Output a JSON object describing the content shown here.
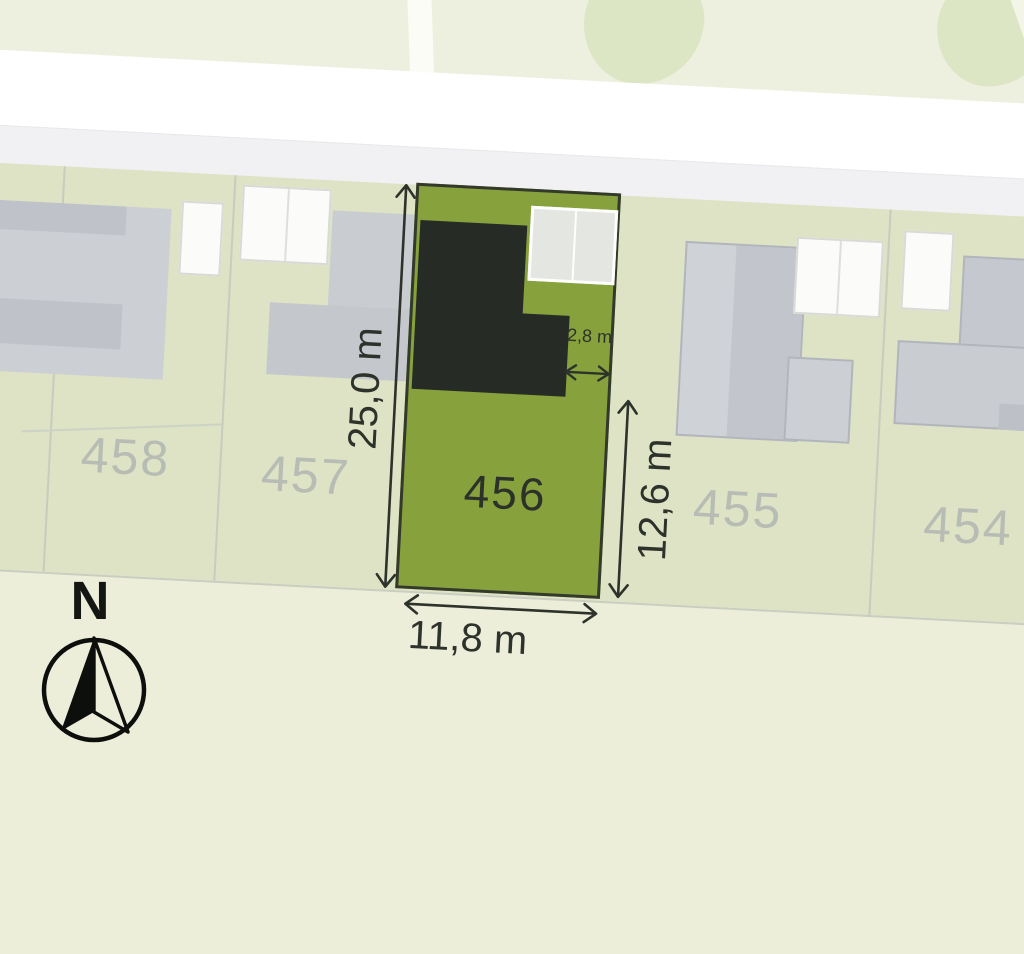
{
  "plots": [
    {
      "id": "458",
      "highlighted": false
    },
    {
      "id": "457",
      "highlighted": false
    },
    {
      "id": "456",
      "highlighted": true
    },
    {
      "id": "455",
      "highlighted": false
    },
    {
      "id": "454",
      "highlighted": false
    }
  ],
  "highlight": {
    "plot_id": "456",
    "dimensions": {
      "left_depth": "25,0 m",
      "right_depth": "12,6 m",
      "front_width": "11,8 m",
      "side_gap": "2,8 m"
    }
  },
  "compass": {
    "label": "N"
  },
  "colors": {
    "highlight_green": "#87a23d",
    "planned_building_dark": "#272b26",
    "plot_fill": "#dde3c4",
    "road_white": "#ffffff",
    "sidewalk_gray": "#f1f1f4",
    "field_green": "#eef0df",
    "verge_green": "#eceeda",
    "building_gray": "#c7cbcf",
    "plot_label_gray": "#b7bcb4",
    "dimension_text": "#2d322b"
  }
}
